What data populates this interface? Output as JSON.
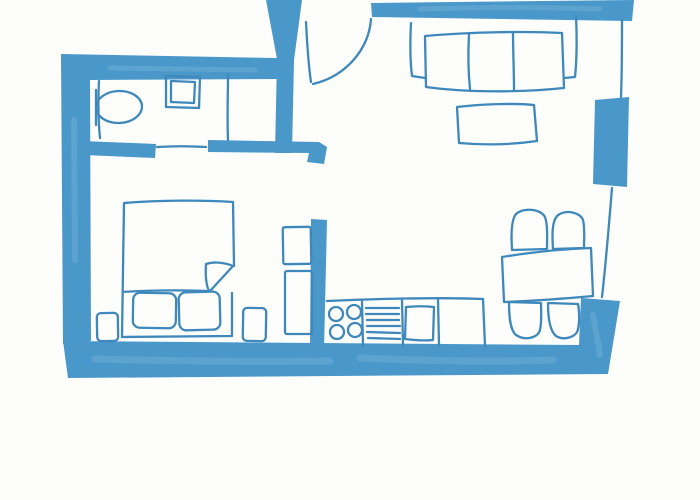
{
  "page": {
    "title": "Hand-drawn apartment floor plan sketch",
    "style": "blue marker line drawing on white paper"
  },
  "colors": {
    "background": "#fdfdfc",
    "wall_fill": "#4a97c9",
    "line": "#3e88bb",
    "wall_highlight": "#76b2da"
  },
  "plan": {
    "rooms": [
      {
        "name": "bathroom",
        "fixtures": [
          "toilet",
          "wash-basin",
          "room-divider",
          "door-line"
        ]
      },
      {
        "name": "entry-hall",
        "fixtures": [
          "entry-door-leaf",
          "entry-door-swing-arc"
        ]
      },
      {
        "name": "living-room",
        "fixtures": [
          "three-seat-sofa",
          "coffee-table",
          "radiator-pier",
          "window-wall"
        ]
      },
      {
        "name": "bedroom",
        "fixtures": [
          "double-bed",
          "folded-blanket-corner",
          "pillow-left",
          "pillow-right",
          "nightstand-left",
          "nightstand-right",
          "wardrobe-upper",
          "wardrobe-lower"
        ]
      },
      {
        "name": "kitchen",
        "fixtures": [
          "counter",
          "stove-four-burners",
          "drying-rack",
          "sink"
        ]
      },
      {
        "name": "dining-area",
        "fixtures": [
          "dining-table",
          "chair-top-left",
          "chair-top-right",
          "chair-bottom-left",
          "chair-bottom-right"
        ]
      }
    ]
  }
}
